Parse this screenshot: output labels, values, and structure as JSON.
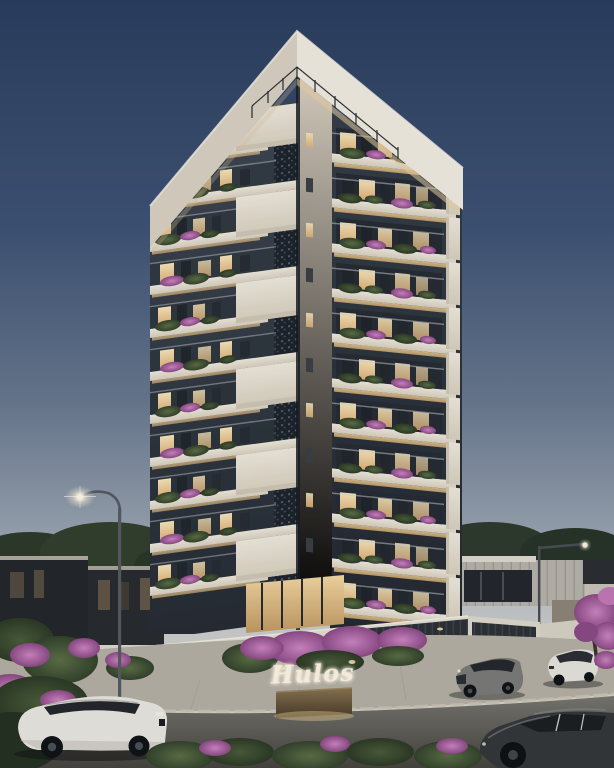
{
  "scene": {
    "sign": {
      "text": "Hulos"
    }
  },
  "palette": {
    "sky_top": "#2b3e60",
    "sky_mid": "#68788f",
    "sky_horizon": "#d6cfc0",
    "crown_white": "#f1ece2",
    "slab_cream": "#efeadf",
    "facade_dark": "#3d4652",
    "window_warm": "#f8e6bb",
    "flower_magenta": "#cd86c2",
    "foliage_green": "#5c7046",
    "wall_white": "#e4dfd4",
    "plaza_gray": "#b5b0a5",
    "road_gray": "#77756f",
    "car_white": "#e9e7e2",
    "car_gray": "#7b7c7a",
    "car_dark": "#33373a"
  }
}
